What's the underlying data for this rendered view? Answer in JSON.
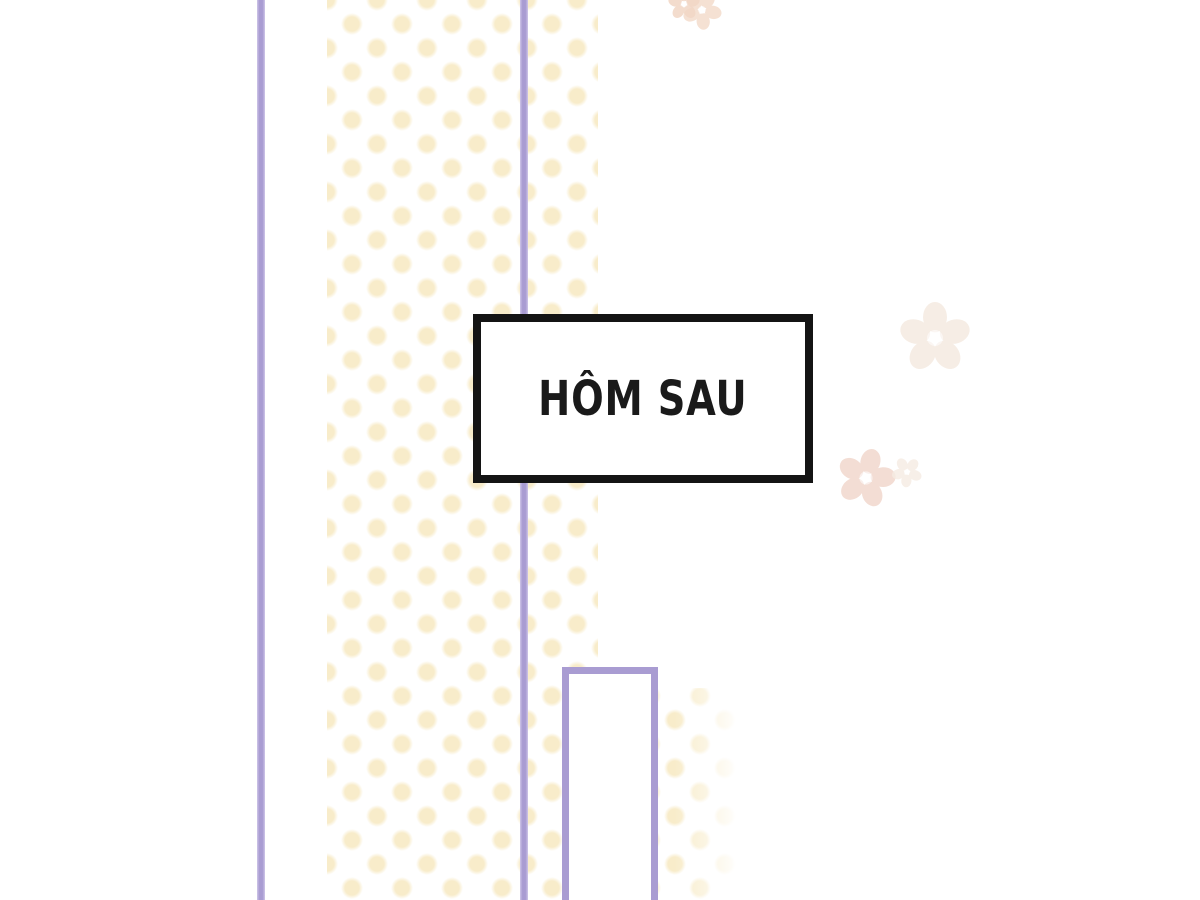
{
  "panel": {
    "type": "comic-transition-panel",
    "caption_box": {
      "text": "HÔM SAU"
    },
    "colors": {
      "background": "#ffffff",
      "line_purple": "#a99cd2",
      "line_purple_light": "#cfc6e8",
      "dot_cream": "#f8ecca",
      "caption_border": "#141414",
      "caption_bg": "#ffffff",
      "caption_text": "#1a1a1a",
      "flower_pink": "#f2dad0",
      "flower_beige": "#f6ece3",
      "flower_peach": "#f2d7c5"
    },
    "decorations": {
      "flowers": [
        "sakura-top-left-small",
        "sakura-top-right-small",
        "sakura-right-upper",
        "sakura-right-lower",
        "sakura-right-lower-small"
      ]
    }
  }
}
